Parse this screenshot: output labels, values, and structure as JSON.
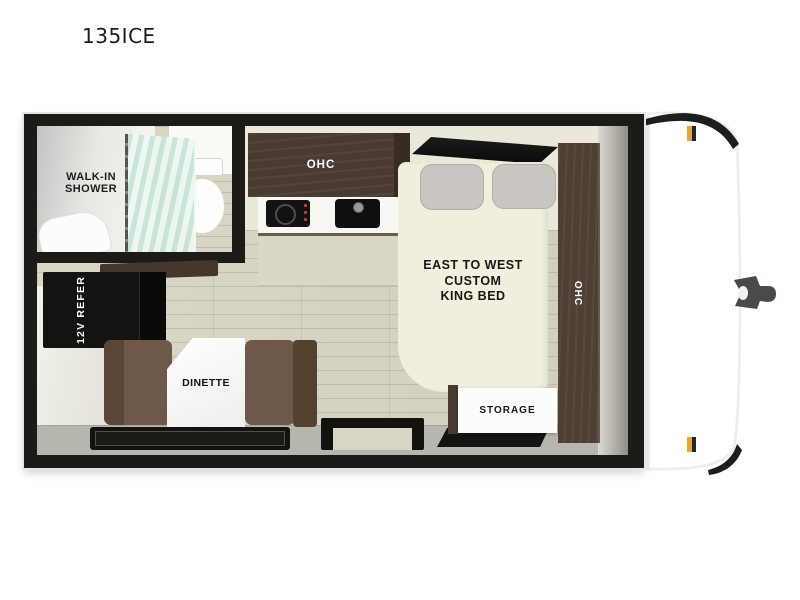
{
  "title": "135ICE",
  "floorplan": {
    "labels": {
      "shower_line1": "WALK-IN",
      "shower_line2": "SHOWER",
      "kitchen_ohc": "OHC",
      "wardrobe_ohc": "OHC",
      "bed_line1": "EAST TO WEST",
      "bed_line2": "CUSTOM",
      "bed_line3": "KING BED",
      "refrigerator": "12V REFER",
      "dinette": "DINETTE",
      "storage": "STORAGE"
    },
    "colors": {
      "wall_frame": "#1d1b18",
      "interior_cream": "#eae7db",
      "floor_wood": "#d8d4c3",
      "cabinet_brown": "#4a3b32",
      "bench_brown": "#6e5847",
      "bed_cream": "#f1eede",
      "walkway_gray": "#b7b6ae",
      "glass_teal": "#c9e4d7",
      "marker_amber": "#e6a53e"
    }
  }
}
